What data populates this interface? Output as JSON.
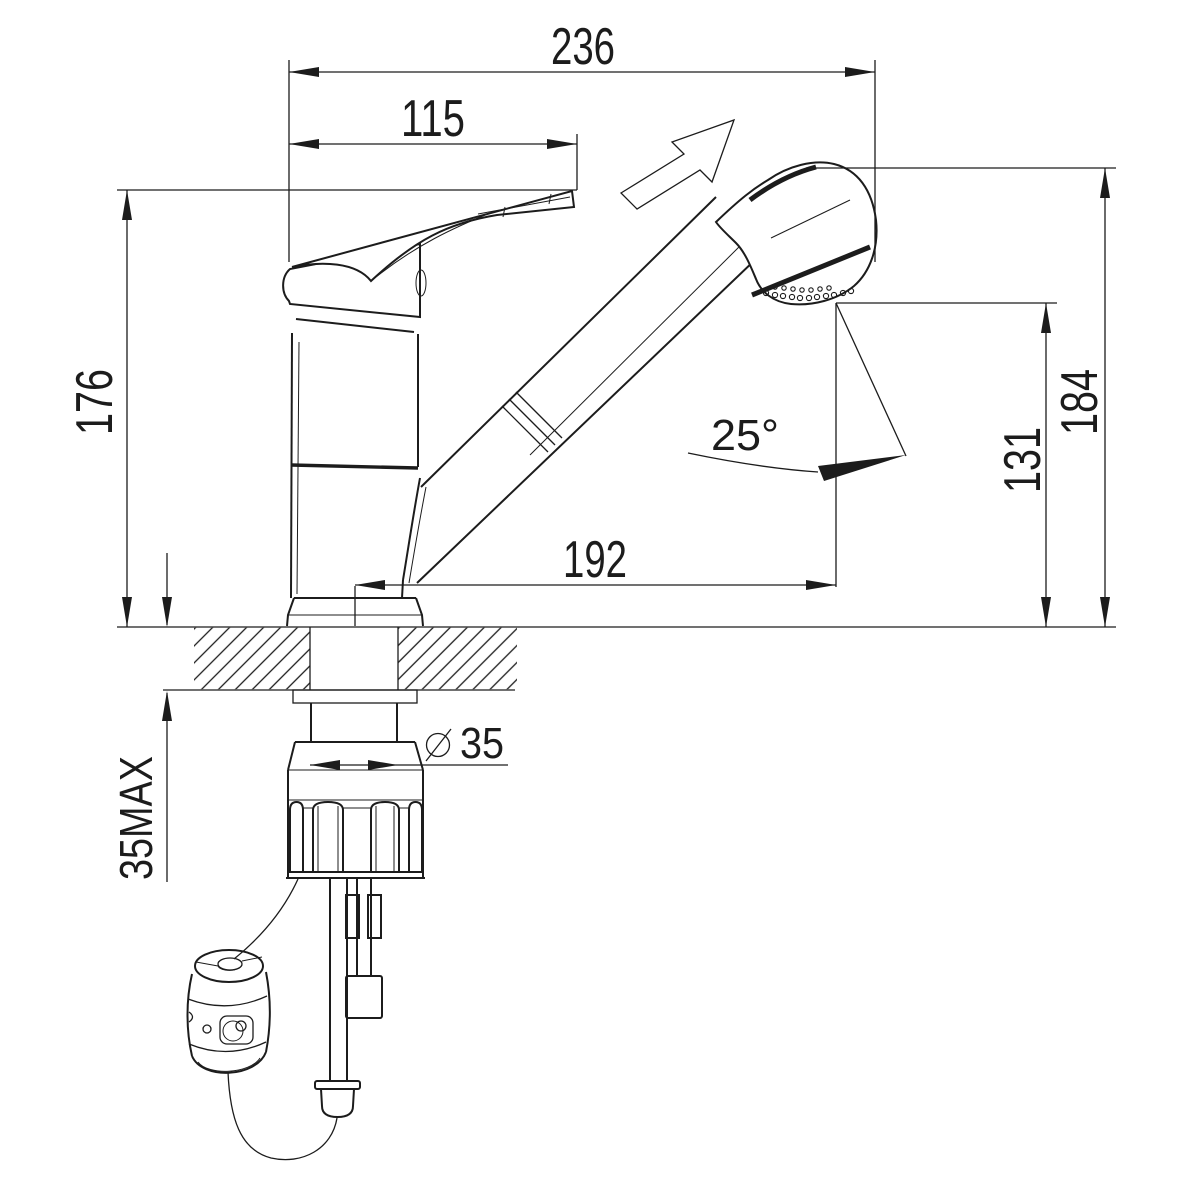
{
  "drawing": {
    "subject": "Single-lever pull-out spray kitchen mixer faucet — side elevation installation drawing",
    "style": "monochrome CAD line drawing with section-hatched countertop",
    "units": "mm",
    "ink_color": "#1c1c1c",
    "paper_color": "#ffffff"
  },
  "dims": {
    "overall_length": "236",
    "handle_length": "115",
    "height_to_lever": "176",
    "height_to_head": "184",
    "outlet_height": "131",
    "reach": "192",
    "spray_angle": "25°",
    "hole_diameter": "35",
    "deck_thickness_max": "35MAX"
  },
  "icons": {
    "pullout_direction_arrow": "open arrow pointing up-right (pull-out direction)",
    "diameter_symbol": "slashed-circle diameter sign",
    "counter_hatch": "45° section hatching of countertop"
  }
}
